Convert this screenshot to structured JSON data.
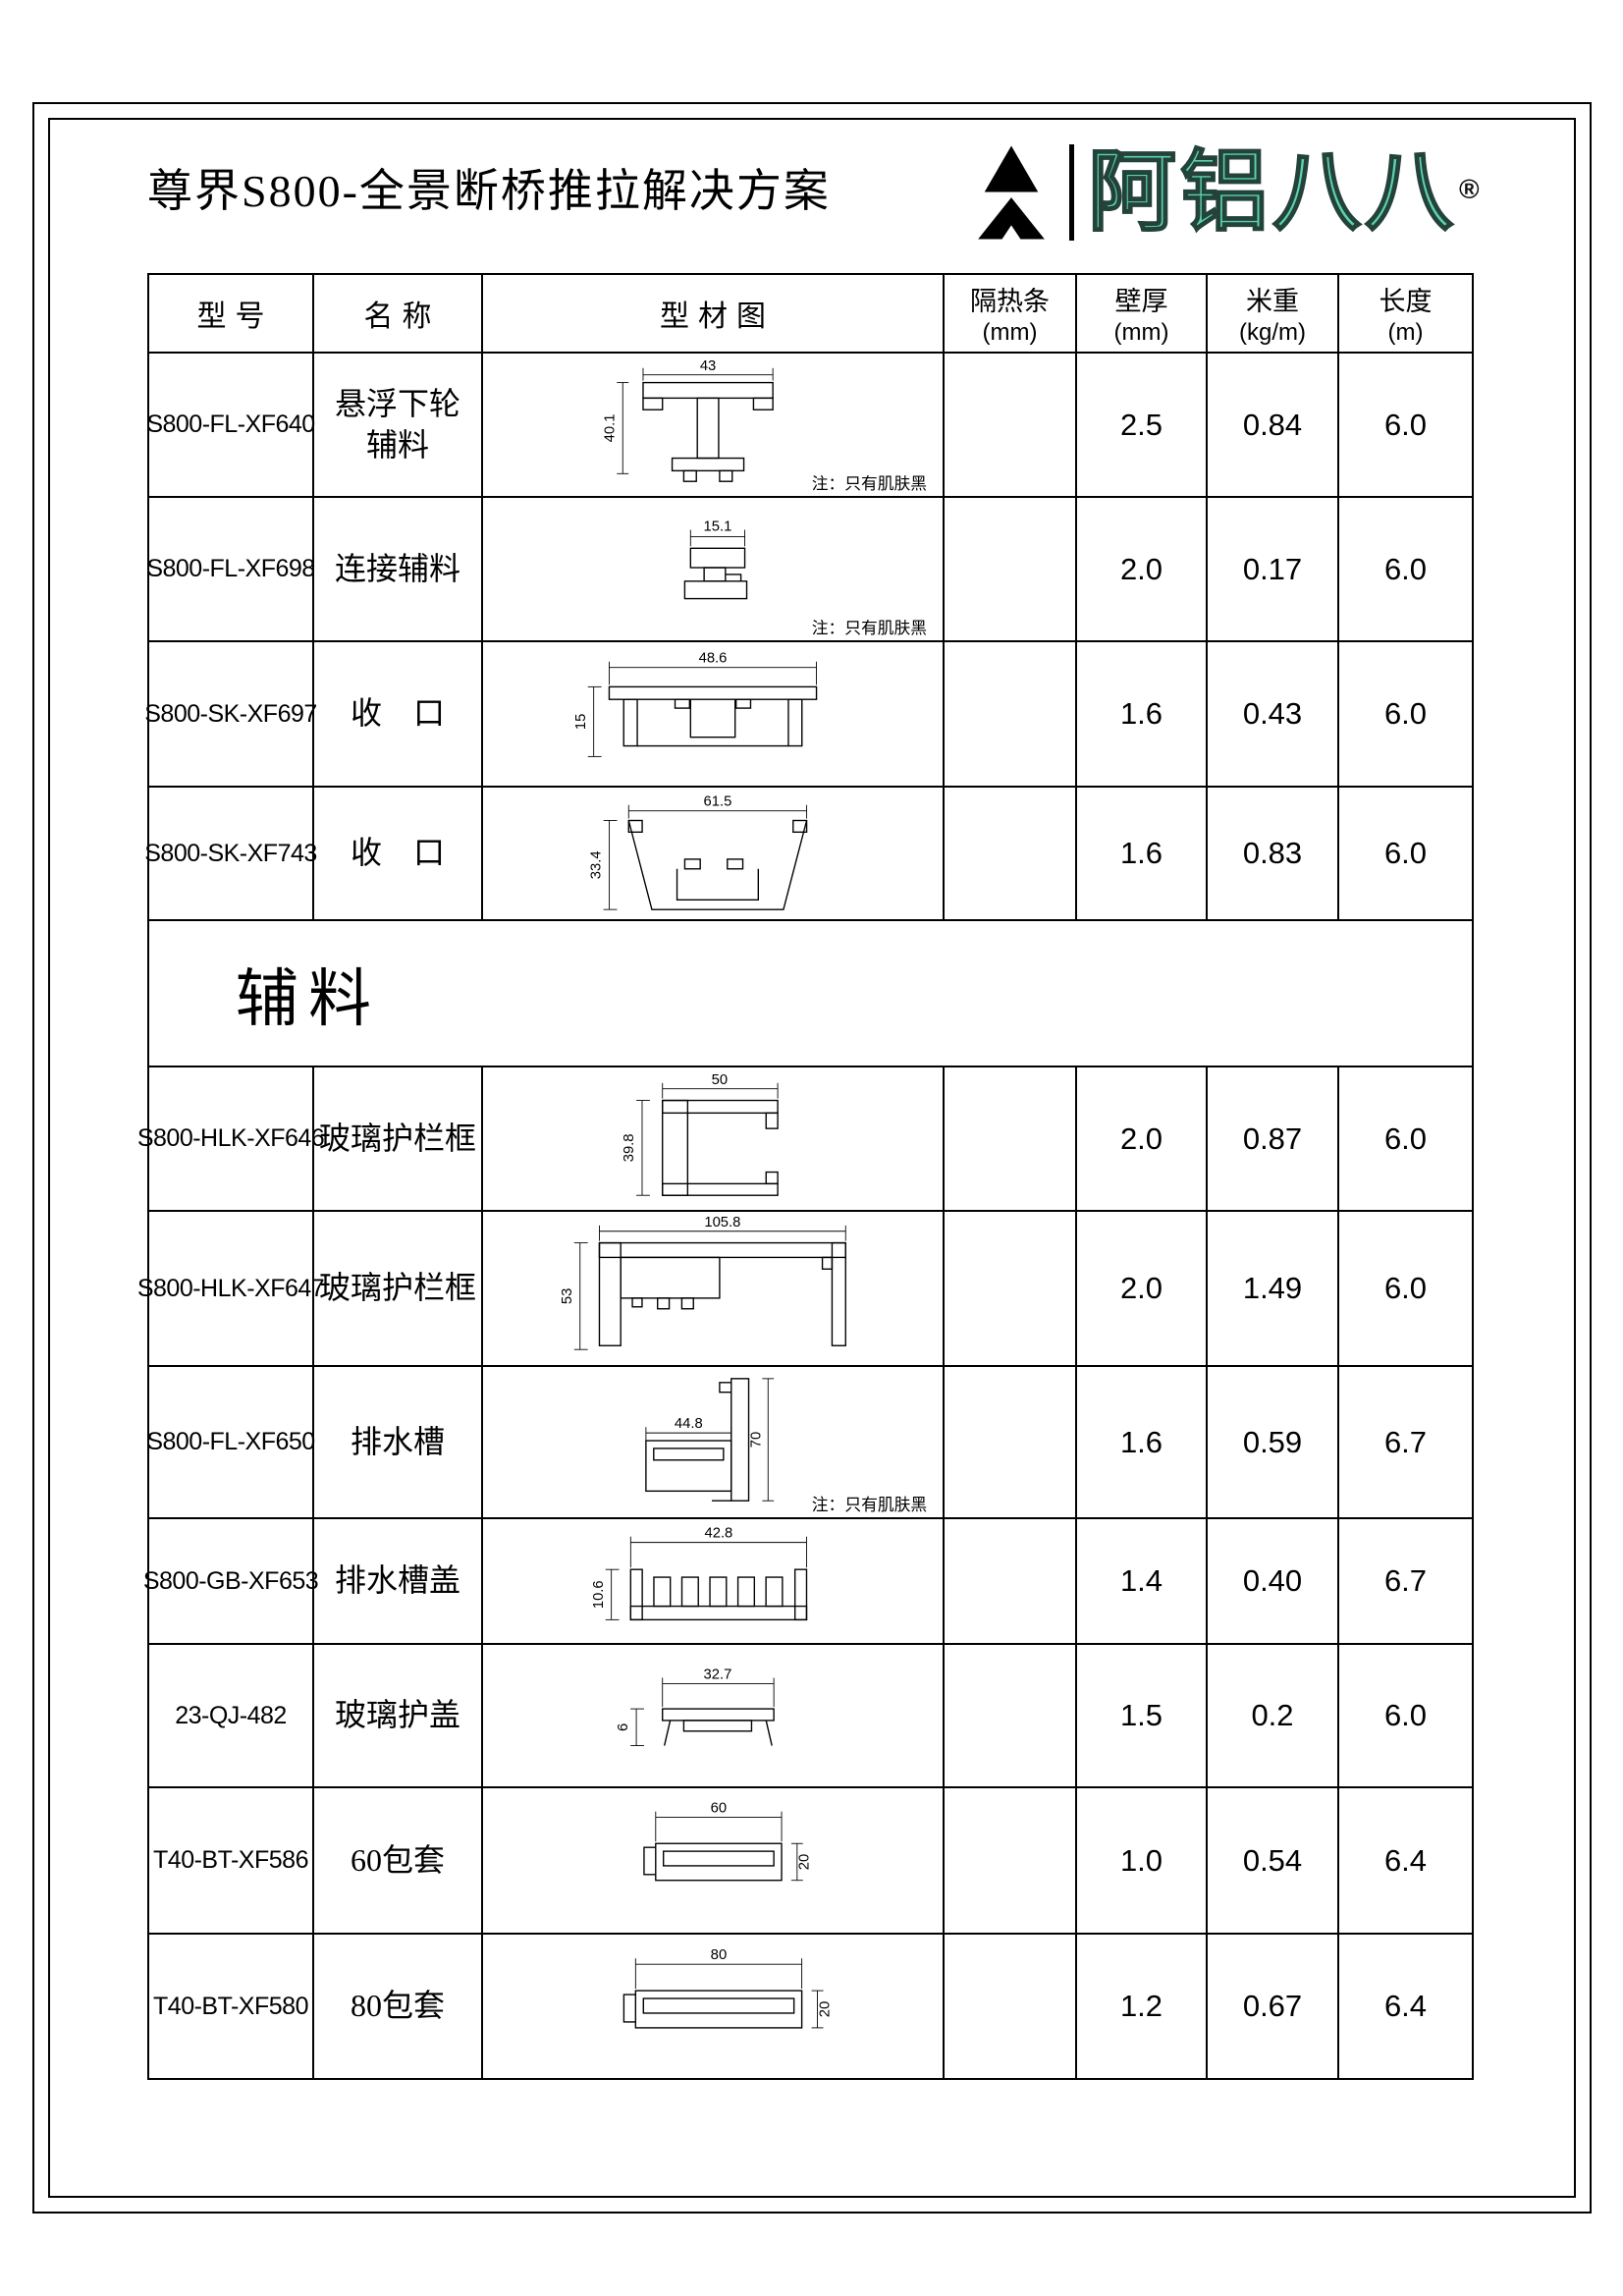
{
  "page": {
    "title": "尊界S800-全景断桥推拉解决方案",
    "logo": {
      "brand": "阿铝八八",
      "registered": "®",
      "accent": "#5cd2ae"
    }
  },
  "table": {
    "headers": [
      {
        "label": "型号",
        "unit": ""
      },
      {
        "label": "名称",
        "unit": ""
      },
      {
        "label": "型材图",
        "unit": ""
      },
      {
        "label": "隔热条",
        "unit": "(mm)"
      },
      {
        "label": "壁厚",
        "unit": "(mm)"
      },
      {
        "label": "米重",
        "unit": "(kg/m)"
      },
      {
        "label": "长度",
        "unit": "(m)"
      }
    ],
    "section_label": "辅料",
    "rows": [
      {
        "model": "S800-FL-XF640",
        "name": "悬浮下轮",
        "name2": "辅料",
        "dim_w": "43",
        "dim_h": "40.1",
        "note": "注：只有肌肤黑",
        "insulation": "",
        "wall": "2.5",
        "weight": "0.84",
        "length": "6.0"
      },
      {
        "model": "S800-FL-XF698",
        "name": "连接辅料",
        "dim_w": "15.1",
        "note": "注：只有肌肤黑",
        "insulation": "",
        "wall": "2.0",
        "weight": "0.17",
        "length": "6.0"
      },
      {
        "model": "S800-SK-XF697",
        "name": "收　口",
        "dim_w": "48.6",
        "dim_h": "15",
        "insulation": "",
        "wall": "1.6",
        "weight": "0.43",
        "length": "6.0"
      },
      {
        "model": "S800-SK-XF743",
        "name": "收　口",
        "dim_w": "61.5",
        "dim_h": "33.4",
        "insulation": "",
        "wall": "1.6",
        "weight": "0.83",
        "length": "6.0"
      },
      {
        "model": "S800-HLK-XF646",
        "name": "玻璃护栏框",
        "dim_w": "50",
        "dim_h": "39.8",
        "insulation": "",
        "wall": "2.0",
        "weight": "0.87",
        "length": "6.0"
      },
      {
        "model": "S800-HLK-XF647",
        "name": "玻璃护栏框",
        "dim_w": "105.8",
        "dim_h": "53",
        "insulation": "",
        "wall": "2.0",
        "weight": "1.49",
        "length": "6.0"
      },
      {
        "model": "S800-FL-XF650",
        "name": "排水槽",
        "dim_w": "44.8",
        "dim_h": "70",
        "note": "注：只有肌肤黑",
        "insulation": "",
        "wall": "1.6",
        "weight": "0.59",
        "length": "6.7"
      },
      {
        "model": "S800-GB-XF653",
        "name": "排水槽盖",
        "dim_w": "42.8",
        "dim_h": "10.6",
        "insulation": "",
        "wall": "1.4",
        "weight": "0.40",
        "length": "6.7"
      },
      {
        "model": "23-QJ-482",
        "name": "玻璃护盖",
        "dim_w": "32.7",
        "dim_h": "6",
        "insulation": "",
        "wall": "1.5",
        "weight": "0.2",
        "length": "6.0"
      },
      {
        "model": "T40-BT-XF586",
        "name": "60包套",
        "dim_w": "60",
        "dim_h": "20",
        "insulation": "",
        "wall": "1.0",
        "weight": "0.54",
        "length": "6.4"
      },
      {
        "model": "T40-BT-XF580",
        "name": "80包套",
        "dim_w": "80",
        "dim_h": "20",
        "insulation": "",
        "wall": "1.2",
        "weight": "0.67",
        "length": "6.4"
      }
    ]
  }
}
